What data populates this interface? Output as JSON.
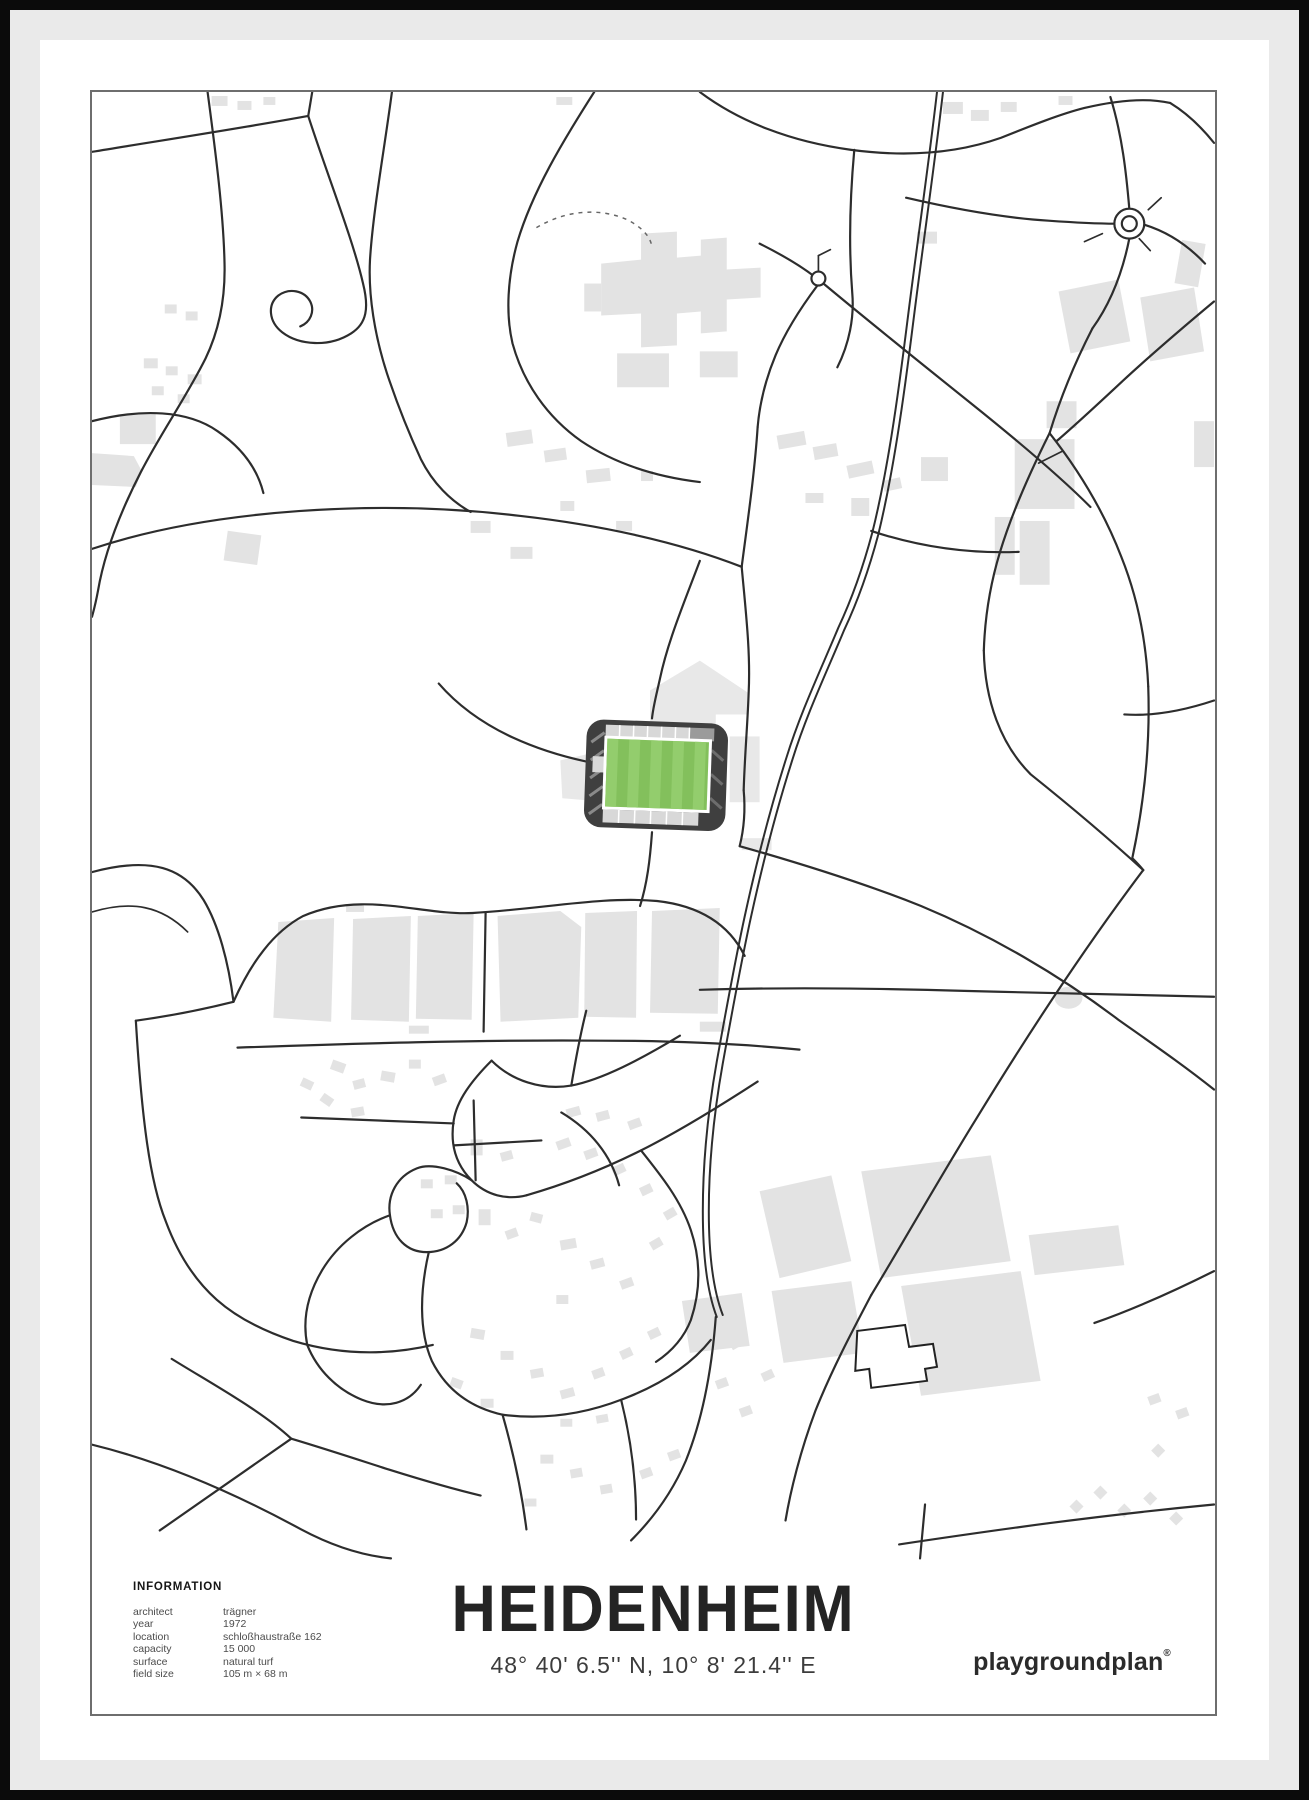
{
  "poster": {
    "title": "HEIDENHEIM",
    "coordinates": "48° 40' 6.5'' N, 10° 8' 21.4'' E",
    "brand": "playgroundplan",
    "brand_mark": "®",
    "info": {
      "heading": "INFORMATION",
      "rows": [
        {
          "label": "architect",
          "value": "trägner"
        },
        {
          "label": "year",
          "value": "1972"
        },
        {
          "label": "location",
          "value": "schloßhaustraße 162"
        },
        {
          "label": "capacity",
          "value": "15 000"
        },
        {
          "label": "surface",
          "value": "natural turf"
        },
        {
          "label": "field size",
          "value": "105 m × 68 m"
        }
      ]
    },
    "colors": {
      "road": "#2d2d2d",
      "building_gray": "#e3e3e3",
      "pitch_green_dark": "#83c05c",
      "pitch_green_light": "#93cd6d",
      "stadium_shell": "#3f3f3f",
      "frame_gray": "#eaeaea",
      "frame_black": "#0b0b0b"
    }
  }
}
